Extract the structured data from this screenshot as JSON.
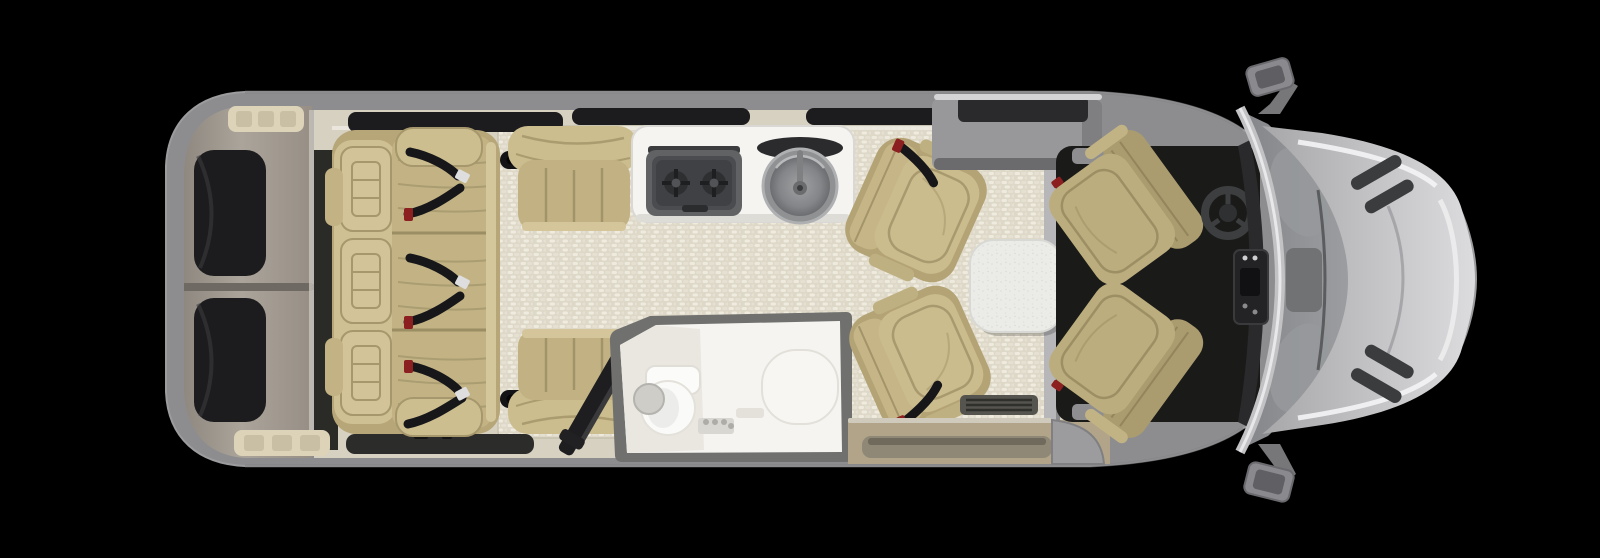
{
  "title": "Class B motorhome floor plan - top view",
  "canvas": {
    "width": 1600,
    "height": 558
  },
  "palette": {
    "background": "#000000",
    "body_gray": "#8d8d8f",
    "body_edge": "#77777a",
    "rear_door": "#a39b90",
    "window_tint": "#1c1c1e",
    "floor_base": "#d7d1c1",
    "aisle_light": "#e9e5d8",
    "furniture_tan": "#c3b384",
    "furniture_tan_light": "#cfc093",
    "furniture_seam": "#a2946a",
    "cab_seat_tan": "#bcad7e",
    "white_surface": "#f5f4f1",
    "cooktop_gray": "#4a4c4f",
    "sink_gray": "#8f9193",
    "seatbelt_black": "#17171a",
    "buckle_red": "#8c1f1f",
    "table_white": "#ebebe8",
    "cab_floor": "#1a1a18",
    "hood_silver": "#c9c9cb",
    "glass_gray": "#898b8e",
    "step_tan": "#b1a489",
    "mat_dark": "#2c2c2a",
    "vent_cream": "#ddd3b9"
  },
  "items": [
    {
      "id": "rear-doors",
      "label": "Rear doors with tinted windows"
    },
    {
      "id": "rear-sofa",
      "label": "Three-seat sofa with seat belts"
    },
    {
      "id": "galley-seat",
      "label": "Galley-side single seat"
    },
    {
      "id": "bath-seat",
      "label": "Bath-side single seat"
    },
    {
      "id": "cooktop",
      "label": "Two-burner cooktop"
    },
    {
      "id": "sink",
      "label": "Round galley sink"
    },
    {
      "id": "bathroom",
      "label": "Wet bath with toilet and shower seat"
    },
    {
      "id": "stowed-table",
      "label": "Stowed folding table"
    },
    {
      "id": "swivel-chair-top",
      "label": "Swivel lounge chair (driver side)"
    },
    {
      "id": "swivel-chair-bottom",
      "label": "Swivel lounge chair (door side)"
    },
    {
      "id": "dining-table",
      "label": "Removable dining table"
    },
    {
      "id": "entry-step",
      "label": "Sliding-door entry step"
    },
    {
      "id": "driver-seat",
      "label": "Driver seat (swiveled rearward)"
    },
    {
      "id": "passenger-seat",
      "label": "Passenger seat (swiveled rearward)"
    },
    {
      "id": "steering-wheel",
      "label": "Steering wheel"
    },
    {
      "id": "dashboard",
      "label": "Dashboard console"
    },
    {
      "id": "windshield",
      "label": "Windshield"
    },
    {
      "id": "hood",
      "label": "Hood"
    },
    {
      "id": "side-mirror-top",
      "label": "Side mirror (driver)"
    },
    {
      "id": "side-mirror-bottom",
      "label": "Side mirror (passenger)"
    }
  ]
}
